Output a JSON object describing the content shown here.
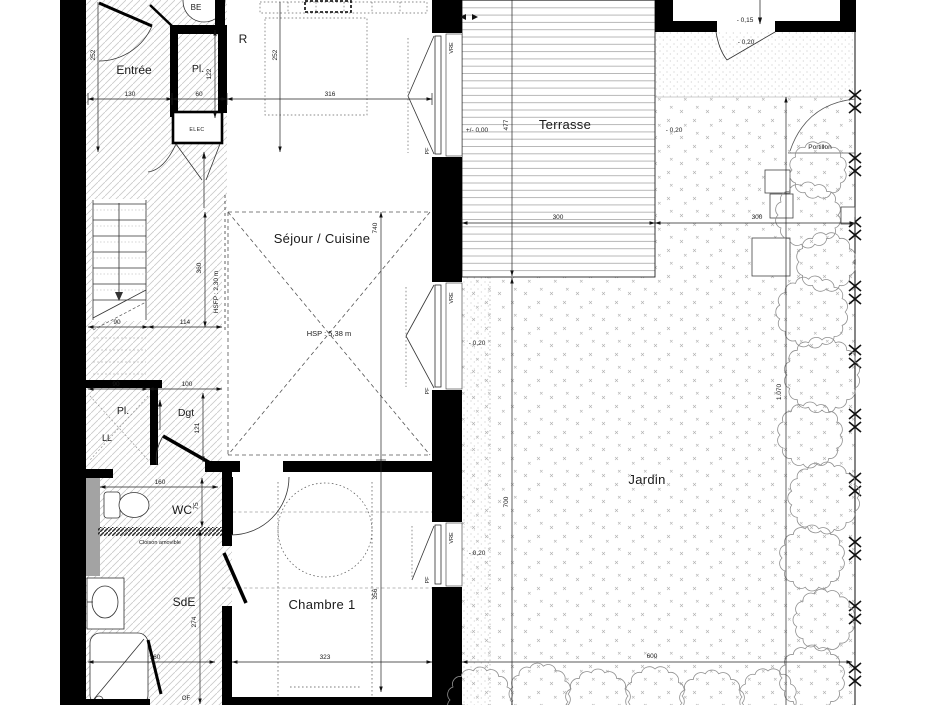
{
  "rooms": {
    "entree": "Entrée",
    "reserve": "R",
    "placard_haut": "Pl.",
    "sejour": "Séjour / Cuisine",
    "placard": "Pl.",
    "lave_linge": "LL",
    "degagement": "Dgt",
    "wc": "WC",
    "salle_eau": "SdE",
    "chambre": "Chambre 1",
    "terrasse": "Terrasse",
    "jardin": "Jardin",
    "be": "BE"
  },
  "openings": {
    "vre": "VRE",
    "pf": "PF",
    "of": "OF",
    "portillon": "Portillon"
  },
  "annotations": {
    "hsp": "HSP : 5,38 m",
    "hsfp": "HSFP : 2,30 m",
    "elec": "ELEC",
    "cloison": "Cloison amovible"
  },
  "levels": {
    "zero": "+/- 0,00",
    "minus15": "- 0,15",
    "minus20": "- 0,20"
  },
  "dims": {
    "d130": "130",
    "d60": "60",
    "d316": "316",
    "d252": "252",
    "d122": "122",
    "d740": "740",
    "d356": "356",
    "d360": "360",
    "d90": "90",
    "d114": "114",
    "d100": "100",
    "d121": "121",
    "d160": "160",
    "d75": "75",
    "d274": "274",
    "d323": "323",
    "d477": "477",
    "d300": "300",
    "d700": "700",
    "d600": "600",
    "d1070": "1.070"
  }
}
